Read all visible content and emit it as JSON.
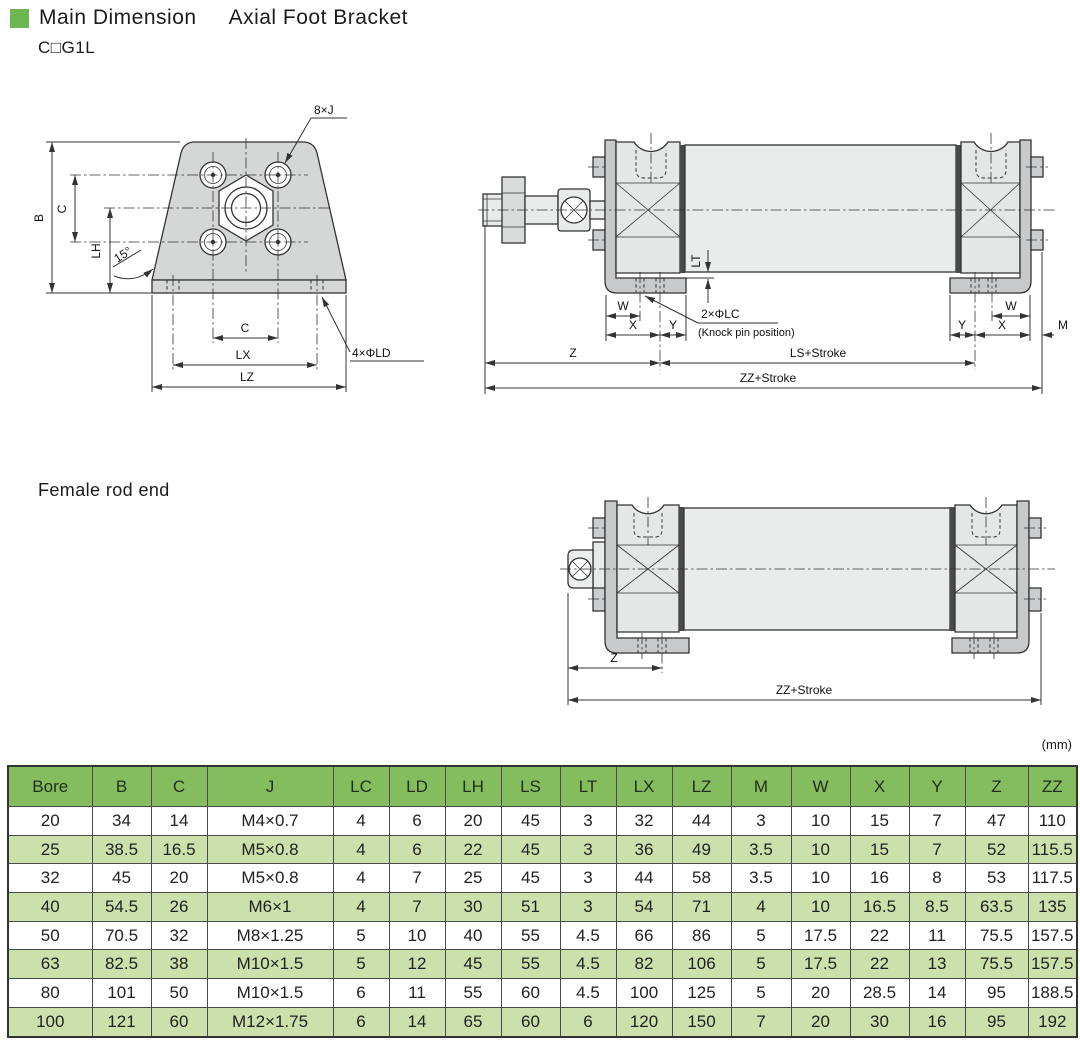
{
  "header": {
    "title_main": "Main Dimension",
    "title_sub": "Axial Foot Bracket",
    "model_code": "C□G1L"
  },
  "sections": {
    "female_label": "Female rod end"
  },
  "front_view": {
    "labels": {
      "b": "B",
      "c_vert": "C",
      "lh": "LH",
      "angle": "15°",
      "c_horiz": "C",
      "lx": "LX",
      "lz": "LZ",
      "bolt_callout": "8×J",
      "hole_callout": "4×ΦLD"
    }
  },
  "side_view": {
    "labels": {
      "lt": "LT",
      "w_left": "W",
      "x_left": "X",
      "y_left": "Y",
      "w_right": "W",
      "y_right": "Y",
      "x_right": "X",
      "m": "M",
      "z": "Z",
      "ls_stroke": "LS+Stroke",
      "zz_stroke": "ZZ+Stroke",
      "lc_callout": "2×ΦLC",
      "lc_note": "(Knock pin position)"
    }
  },
  "female_view": {
    "labels": {
      "z": "Z",
      "zz_stroke": "ZZ+Stroke"
    }
  },
  "table_section": {
    "units_label": "(mm)",
    "headers": [
      "Bore",
      "B",
      "C",
      "J",
      "LC",
      "LD",
      "LH",
      "LS",
      "LT",
      "LX",
      "LZ",
      "M",
      "W",
      "X",
      "Y",
      "Z",
      "ZZ"
    ],
    "rows": [
      [
        "20",
        "34",
        "14",
        "M4×0.7",
        "4",
        "6",
        "20",
        "45",
        "3",
        "32",
        "44",
        "3",
        "10",
        "15",
        "7",
        "47",
        "110"
      ],
      [
        "25",
        "38.5",
        "16.5",
        "M5×0.8",
        "4",
        "6",
        "22",
        "45",
        "3",
        "36",
        "49",
        "3.5",
        "10",
        "15",
        "7",
        "52",
        "115.5"
      ],
      [
        "32",
        "45",
        "20",
        "M5×0.8",
        "4",
        "7",
        "25",
        "45",
        "3",
        "44",
        "58",
        "3.5",
        "10",
        "16",
        "8",
        "53",
        "117.5"
      ],
      [
        "40",
        "54.5",
        "26",
        "M6×1",
        "4",
        "7",
        "30",
        "51",
        "3",
        "54",
        "71",
        "4",
        "10",
        "16.5",
        "8.5",
        "63.5",
        "135"
      ],
      [
        "50",
        "70.5",
        "32",
        "M8×1.25",
        "5",
        "10",
        "40",
        "55",
        "4.5",
        "66",
        "86",
        "5",
        "17.5",
        "22",
        "11",
        "75.5",
        "157.5"
      ],
      [
        "63",
        "82.5",
        "38",
        "M10×1.5",
        "5",
        "12",
        "45",
        "55",
        "4.5",
        "82",
        "106",
        "5",
        "17.5",
        "22",
        "13",
        "75.5",
        "157.5"
      ],
      [
        "80",
        "101",
        "50",
        "M10×1.5",
        "6",
        "11",
        "55",
        "60",
        "4.5",
        "100",
        "125",
        "5",
        "20",
        "28.5",
        "14",
        "95",
        "188.5"
      ],
      [
        "100",
        "121",
        "60",
        "M12×1.75",
        "6",
        "14",
        "65",
        "60",
        "6",
        "120",
        "150",
        "7",
        "20",
        "30",
        "16",
        "95",
        "192"
      ]
    ]
  },
  "colors": {
    "accent_green": "#6cb752",
    "table_header_bg": "#85bd5e",
    "table_row_alt_bg": "#cbe0ab"
  }
}
